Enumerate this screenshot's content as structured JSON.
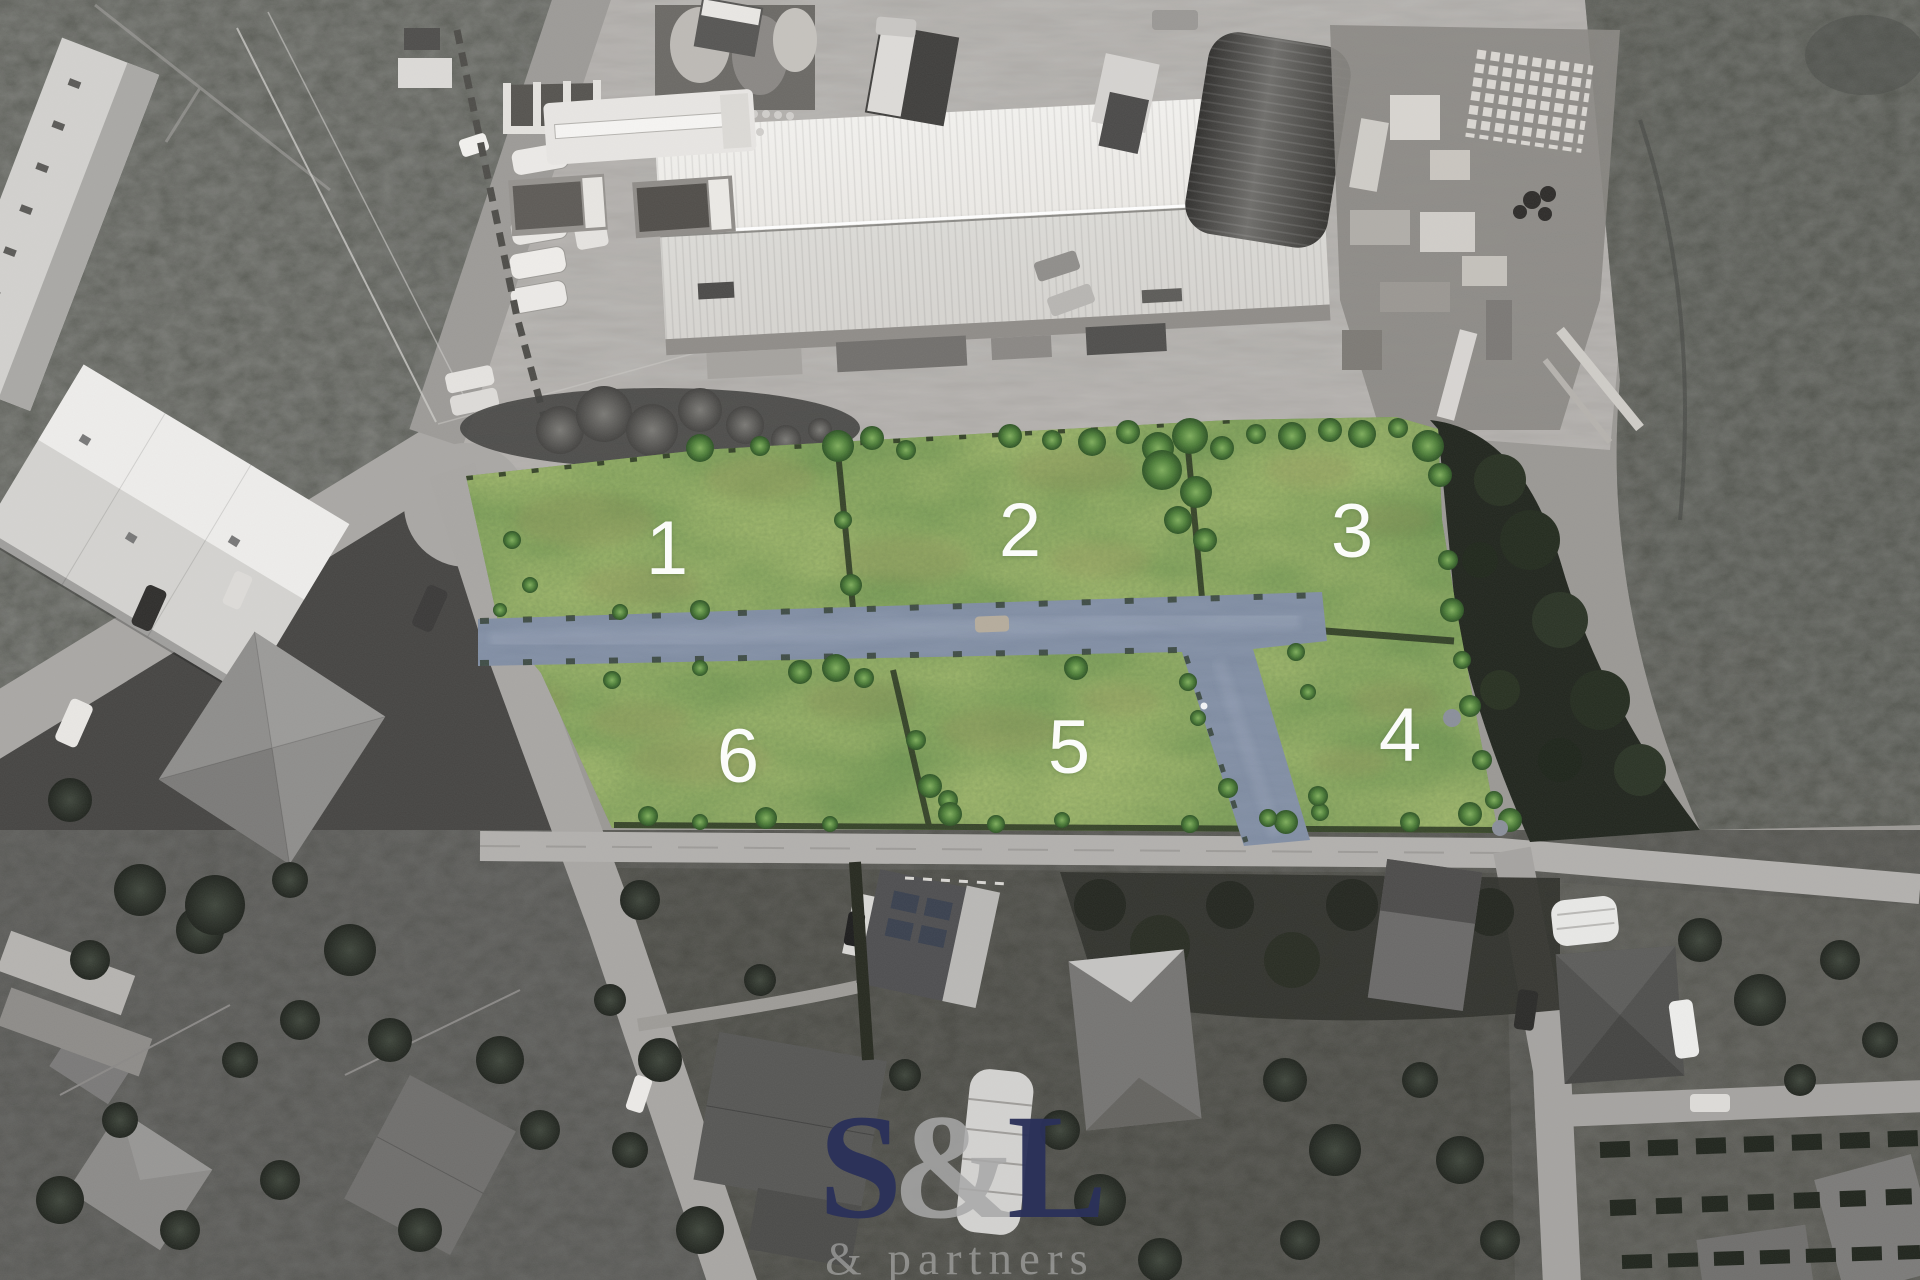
{
  "scene": {
    "description": "Grayscale aerial drone photo with six highlighted green building plots and a blue access road overlay"
  },
  "plots": [
    {
      "id": "plot-1",
      "label": "1"
    },
    {
      "id": "plot-2",
      "label": "2"
    },
    {
      "id": "plot-3",
      "label": "3"
    },
    {
      "id": "plot-4",
      "label": "4"
    },
    {
      "id": "plot-5",
      "label": "5"
    },
    {
      "id": "plot-6",
      "label": "6"
    }
  ],
  "watermark": {
    "letter_s": "S",
    "ampersand": "&",
    "letter_l": "L",
    "subtitle": "& partners"
  },
  "colors": {
    "plot_green": "#56813d",
    "road_overlay_blue": "#75849d",
    "watermark_navy": "#2b315a",
    "watermark_gray": "#a8a8a8",
    "plot_number_white": "#ffffff"
  }
}
